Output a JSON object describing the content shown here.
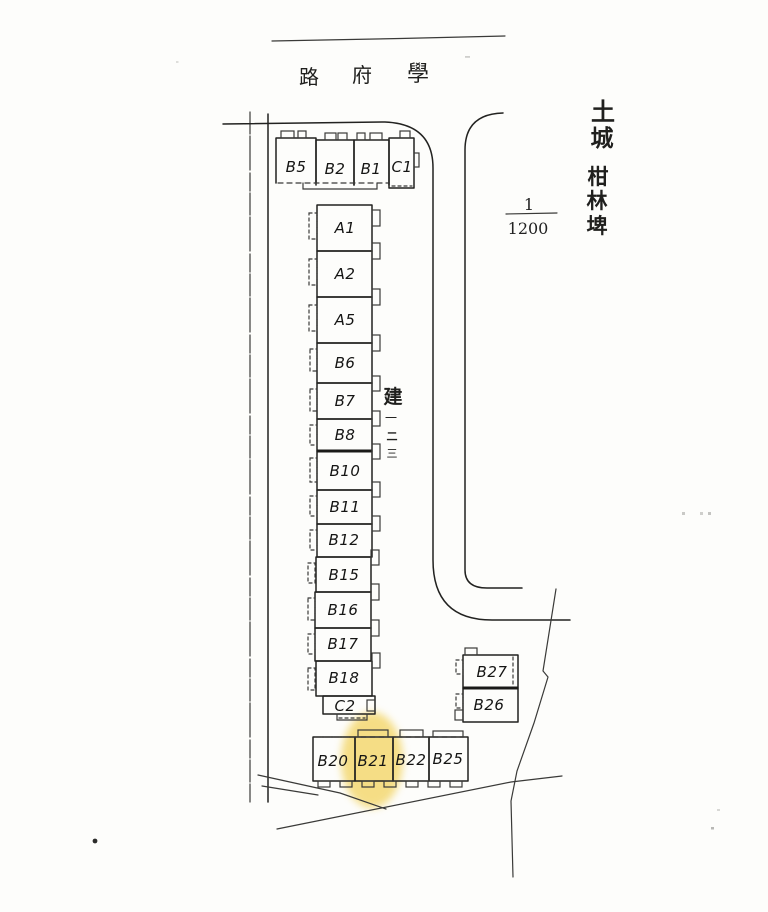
{
  "map": {
    "street_chars": [
      "路",
      "府",
      "學"
    ],
    "district_chars": [
      "土",
      "城"
    ],
    "place_chars": [
      "柑",
      "林",
      "埤"
    ],
    "note_chars": [
      "建",
      "一",
      "二",
      "三"
    ],
    "scale": {
      "numerator": "1",
      "denominator": "1200"
    },
    "blocks": {
      "top_row": [
        "B5",
        "B2",
        "B1",
        "C1"
      ],
      "main_column": [
        "A1",
        "A2",
        "A5",
        "B6",
        "B7",
        "B8",
        "B10",
        "B11",
        "B12",
        "B15",
        "B16",
        "B17",
        "B18",
        "C2"
      ],
      "east_pair": [
        "B27",
        "B26"
      ],
      "bottom_row": [
        "B20",
        "B21",
        "B22",
        "B25"
      ]
    },
    "highlight": {
      "block": "B21",
      "color": "#f2d158"
    }
  }
}
